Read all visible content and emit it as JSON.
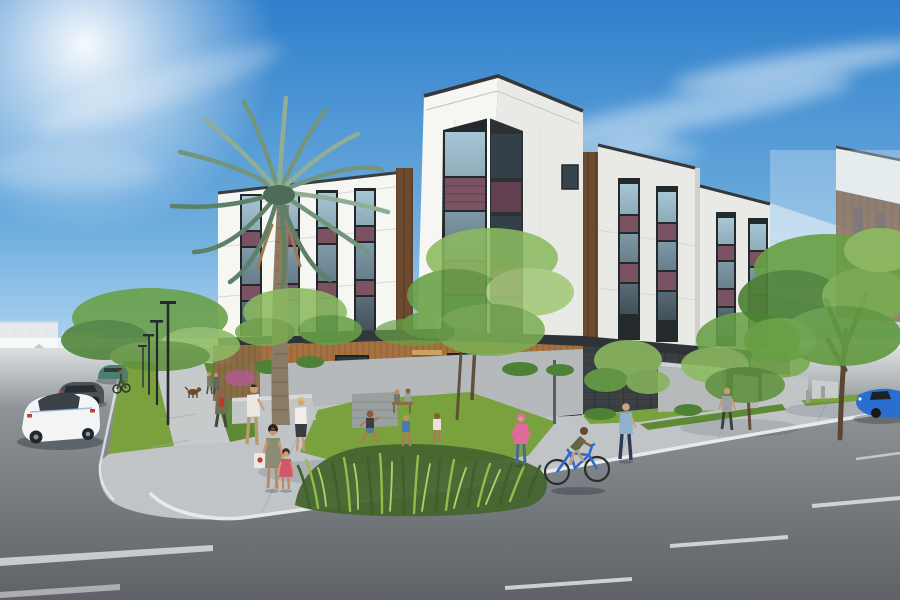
{
  "scene": {
    "description": "Photorealistic architectural rendering of a modern four-story apartment building on a sunny street corner, with white panel facades, maroon accent panels, dark framed windows, wood-clad ground floor, a tall palm tree, street trees, lawns, ornamental grass beds, pedestrians, children playing, a cyclist, parked cars and roads with lane markings under a blue sky with wispy clouds",
    "time_of_day": "day",
    "sky": "clear blue with thin cirrus clouds and bright sun glow at upper left"
  },
  "palette": {
    "sky_top": "#2f7fcb",
    "sky_mid": "#6faede",
    "sky_horizon": "#d8ecf9",
    "cloud": "#ffffff",
    "facade_white_lit": "#f6f6f3",
    "facade_white_shade": "#e9eae6",
    "parapet_cap": "#3a3e40",
    "accent_maroon": "#7b5261",
    "window_frame": "#23282b",
    "window_glass": "#41505a",
    "glass_reflection": "#a6c6d6",
    "wood_upper": "#6b4a2f",
    "wood_ground": "#a4713f",
    "fascia_dark": "#2e3337",
    "screen_dark": "#3b4043",
    "concrete_wall": "#b7babb",
    "sidewalk": "#c0c4c6",
    "curb_white": "#e9eced",
    "asphalt_near": "#5e6266",
    "asphalt_far": "#9ba1a5",
    "grass": "#79a23f",
    "grass_shade": "#5d8a33",
    "ornamental_grass": "#93bd4a",
    "foliage_bright": "#8cba60",
    "foliage_mid": "#68a046",
    "foliage_dark": "#4d8136",
    "palm_frond": "#74957d",
    "palm_trunk": "#8b7b64",
    "distant_building": "#e6eaec",
    "conifer": "#40694a",
    "car_white": "#f2f4f6",
    "car_gray": "#4b5359",
    "car_teal": "#4a8070",
    "car_blue": "#2a6fd0",
    "bike_blue": "#2f68c8",
    "person_pink": "#e06a9b",
    "person_red": "#c0392b",
    "person_olive": "#6f7052",
    "person_blue_shirt": "#8fb0cf"
  },
  "building": {
    "stories": 4,
    "wings": [
      "left wing along side street",
      "tall corner tower bay",
      "right wing block one",
      "right wing block two",
      "far right wing with wood siding",
      "ghosted breezeway structure"
    ],
    "materials": [
      "white fiber-cement panels",
      "maroon metal accent panels",
      "dark anodized window frames",
      "vertical wood siding accents",
      "wood slat ground floor",
      "dark metal fascia and screen wall"
    ],
    "ground_floor": [
      "wood slat cladding",
      "storefront windows",
      "dark entry door",
      "slatted screen",
      "dark garage screen wall"
    ]
  },
  "landscape": {
    "palm_trees": 1,
    "street_trees": 7,
    "lawns": 3,
    "ornamental_grass_bed": 1,
    "shrub_rows": 2,
    "bougainvillea": 1
  },
  "street_furniture": {
    "street_lamps": 4,
    "bollards": 2,
    "sign_posts": 1,
    "concrete_walls": 4,
    "low_planter_walls": 2,
    "wood_fences": 1,
    "green_bin": 1
  },
  "vehicles": [
    {
      "name": "white-sedan-rear-view"
    },
    {
      "name": "dark-gray-sedan"
    },
    {
      "name": "teal-compact-car"
    },
    {
      "name": "blue-sports-car-right-edge"
    },
    {
      "name": "blue-bicycle-with-rider"
    },
    {
      "name": "distant-bicycle-rider"
    }
  ],
  "people": [
    {
      "name": "mother-with-tote-bag"
    },
    {
      "name": "girl-in-pink-dress"
    },
    {
      "name": "man-in-khaki"
    },
    {
      "name": "blonde-woman-white-top"
    },
    {
      "name": "man-in-red-shirt-olive-jacket"
    },
    {
      "name": "distant-couple"
    },
    {
      "name": "brown-dog"
    },
    {
      "name": "child-in-pink-hoodie"
    },
    {
      "name": "running-boy"
    },
    {
      "name": "child-in-blue"
    },
    {
      "name": "girl-in-white"
    },
    {
      "name": "seated-pair-at-table"
    },
    {
      "name": "cyclist"
    },
    {
      "name": "man-in-blue-shirt"
    },
    {
      "name": "man-in-gray-tank"
    }
  ],
  "roads": {
    "lane_markings": "dashed white center line receding right",
    "crosswalk_bars": 2,
    "streets": [
      "side street receding upper left",
      "main street across foreground"
    ]
  }
}
